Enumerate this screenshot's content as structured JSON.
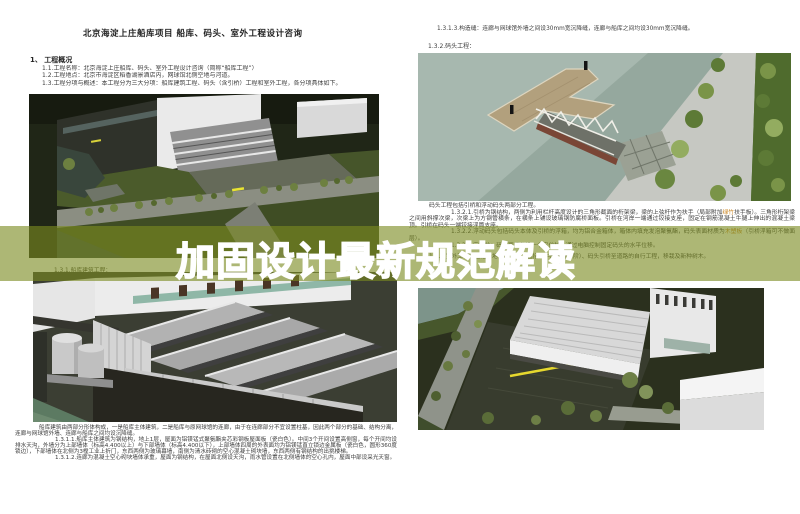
{
  "header": {
    "title": "北京海淀上庄船库项目 船库、码头、室外工程设计咨询"
  },
  "overview": {
    "heading": "1、 工程概况",
    "items": [
      "1.1.工程名称：北京海淀上庄船库、码头、室外工程设计咨询（简称“船库工程”）",
      "1.2.工程地点：北京市海淀区稻香湖景酒店内，网球馆北侧空地与河道。",
      "1.3.工程分项与概述：本工程分为三大分项：船库建筑工程、码头（含引桥）工程和室外工程，各分项具体如下。"
    ]
  },
  "right_top": {
    "joint_note": "1.3.1.3.构造缝：连廊与网球馆外墙之间设30mm宽沉降缝，连廊与船库之间均设30mm宽沉降缝。",
    "wharf_heading": "1.3.2.码头工程："
  },
  "wharf": {
    "intro": "码头工程包括引桥和浮动码头两部分工程。",
    "p1": {
      "pre": "1.3.2.1.引桥为钢结构，两侧为利用栏杆高度设计的三角形截面的桁架梁，梁的上弦杆作为扶手（局部附加",
      "highlight": "绿竹",
      "post": "扶手板）。三角形桁架梁之间用斜撑次梁，次梁上为方钢管横条，在横条上铺设玻璃钢防腐桥面板。引桥在河岸一端通过铰接支座，固定在钢筋混凝土牛腿上伸出的混凝土梁顶。引桥在码头一端铰接浮筒支座。"
    },
    "p2": {
      "pre": "1.3.2.2.浮动码头包括码头本体及引桥的浮箱，均为铝合金箱体，箱体内填充发泡聚氨酯，码头表面材质为",
      "highlight": "木塑板",
      "post": "（引桥浮箱可不做面层）。"
    },
    "p3": "1.3.2.3.定位柱：码头两端各设一个定位柱，通过电脑控制固定码头的水平位移。",
    "p4": "1.3.3.室外工程：包括场地铺装工程（包括其中的室外台阶）、码头引桥至道路的自行工程，移栽及新种树木。"
  },
  "boathouse": {
    "caption": "1.3.1.船库建筑工程：",
    "paras": [
      "船库建筑由两部分形体构成，一是船库主体建筑，二是船库与原网球馆的连廊，由于在连廊部分不宜设置柱基，因此两个部分的基础、结构分离，连廊与网球馆外墙、连廊与船库之间均设沉降缝。",
      "1.3.1.1.船库主体建筑为钢结构，地上1层，屋面为铝镁锰式聚氨酯夹芯彩钢板屋面板（瓷白色）。中间3个开间设置高侧窗，每个开间均设排水天沟，外墙分为上部墙体（标高4.400以上）与下部墙体（标高4.400以下），上部墙体四周的外表面均为铝镁锰直立锁边金属板（瓷白色，圆形360度锁边），下部墙体在北侧为3樘工业上折门，东西两侧为玻璃幕墙，南侧为清水砖砌的空心混凝土砌块墙，东西两侧有钢结构的出挑楼梯。",
      "1.3.1.2.连廊为混凝土空心砌块墙体承重，屋面为钢结构，在屋面北侧设天沟，雨水管设置在北侧墙体的空心孔内，屋面中部设采光天窗。"
    ]
  },
  "banner": {
    "text": "加固设计最新规范解读"
  },
  "colors": {
    "banner_overlay": "#7a8b21",
    "banner_overlay_opacity": "0.62",
    "banner_text": "#ffffff",
    "highlight_text": "#c9831f",
    "body_text": "#3b3b3b",
    "page_background": "#ffffff"
  }
}
